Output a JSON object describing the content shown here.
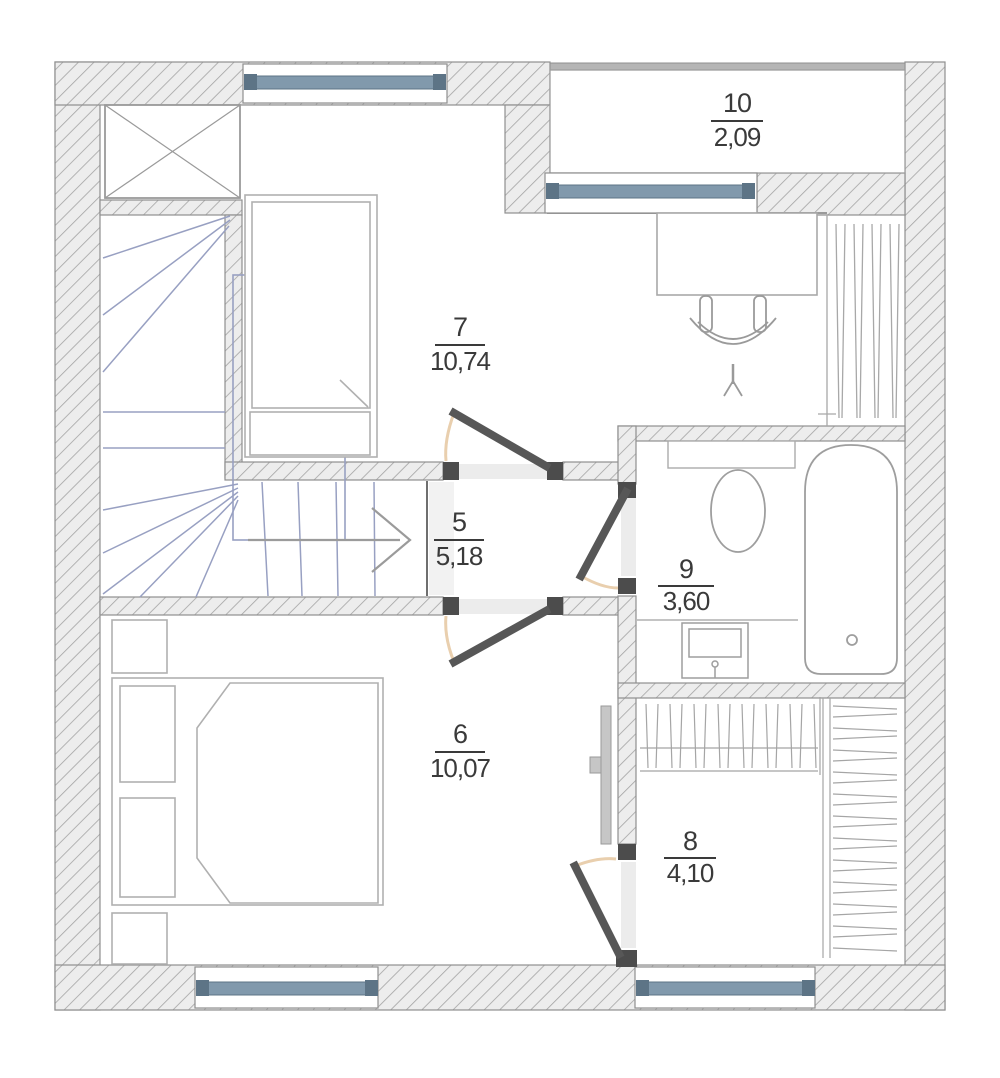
{
  "rooms": {
    "r7": {
      "number": "7",
      "area": "10,74"
    },
    "r5": {
      "number": "5",
      "area": "5,18"
    },
    "r6": {
      "number": "6",
      "area": "10,07"
    },
    "r8": {
      "number": "8",
      "area": "4,10"
    },
    "r9": {
      "number": "9",
      "area": "3,60"
    },
    "r10": {
      "number": "10",
      "area": "2,09"
    }
  },
  "colors": {
    "wall_fill": "#ededed",
    "wall_hatch": "#a3a3a3",
    "window_glass": "#8199ac",
    "window_frame": "#5d7486",
    "stair_tread": "#98a0c2",
    "door_leaf": "#575757",
    "door_swing": "#e9cfae",
    "furniture_line": "#b0b0b0",
    "label_text": "#3a3a3a"
  }
}
